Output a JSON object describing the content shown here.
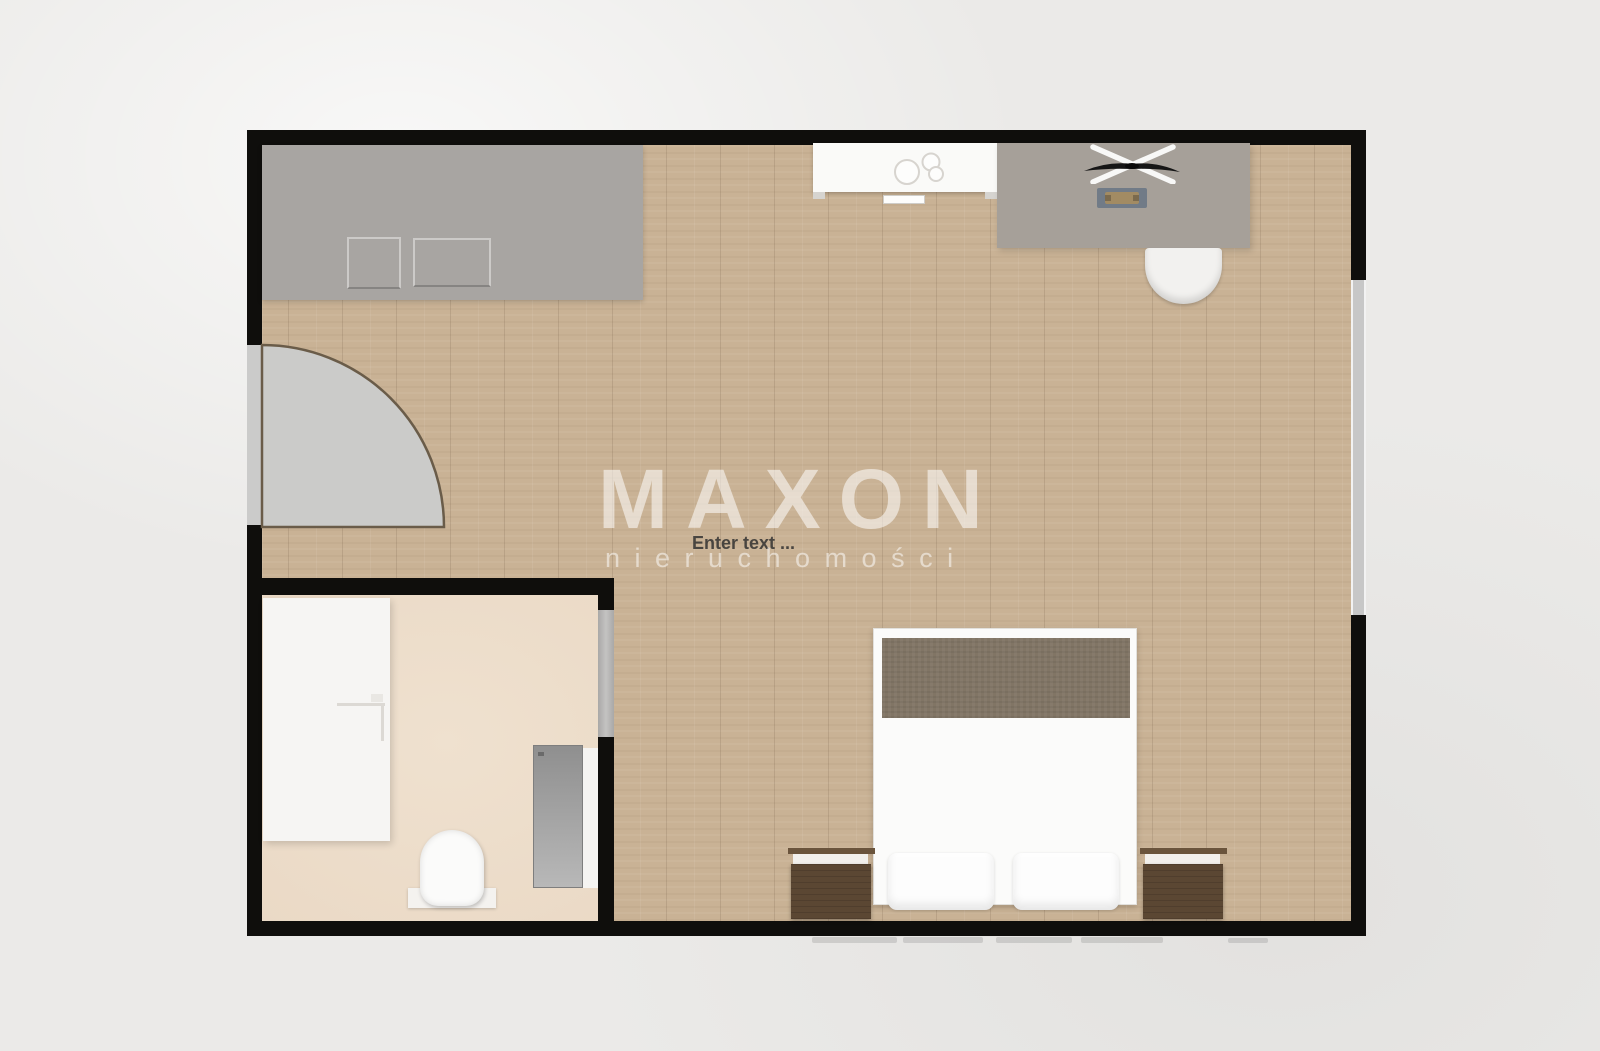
{
  "watermark": {
    "title": "MAXON",
    "subtitle": "nieruchomości",
    "color": "#ffffff"
  },
  "labels": {
    "placeholder": "Enter text ..."
  },
  "palette": {
    "background": "#ebeae8",
    "wall": "#0f0e0c",
    "wood_floor": "#c9b295",
    "bathroom_floor": "#ecdcc9",
    "wardrobe_gray": "#a8a5a2",
    "desk_gray": "#a6a099",
    "blanket_brown": "#817565",
    "nightstand_brown": "#5b4733",
    "door_swing_gray": "#cbcbc9",
    "window_gray": "#c7c7c7",
    "fixture_white": "#fbfbfa"
  },
  "objects": [
    "wardrobe",
    "sink-cabinet",
    "ceiling-fan",
    "desk",
    "keyboard",
    "desk-chair",
    "window",
    "entry-door-opening",
    "entry-door-swing",
    "double-bed",
    "blanket",
    "pillow-left",
    "pillow-right",
    "nightstand-left",
    "nightstand-right",
    "bathtub",
    "shower-enclosure",
    "shower-panel",
    "toilet",
    "bathroom-door-opening"
  ]
}
